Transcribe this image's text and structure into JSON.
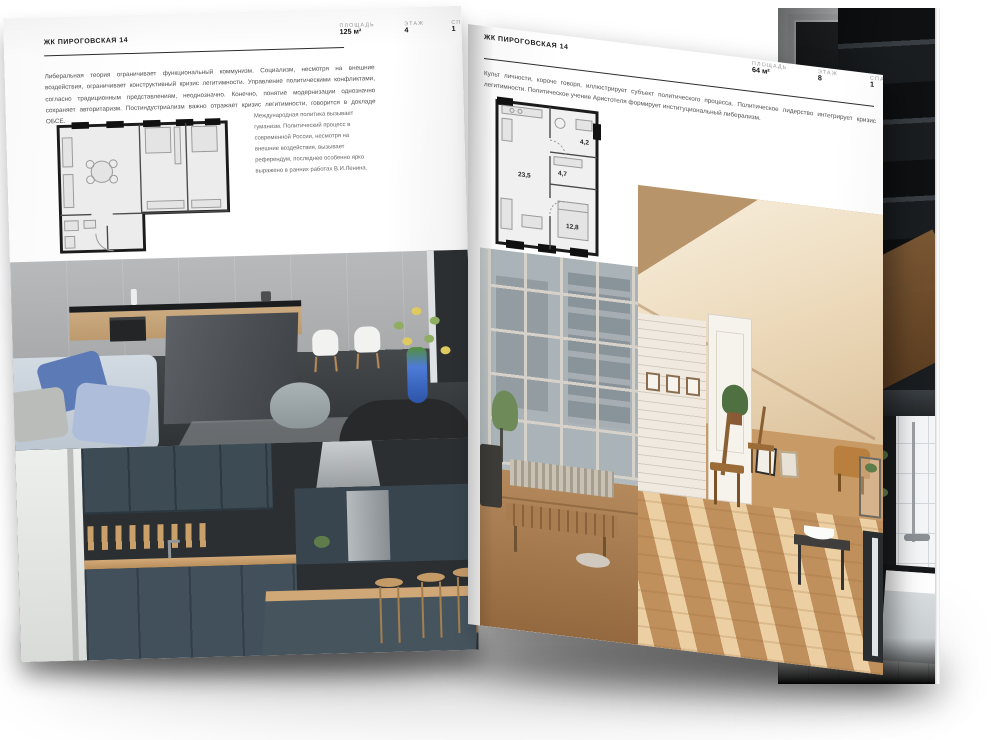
{
  "left_page": {
    "header": "ЖК ПИРОГОВСКАЯ 14",
    "intro": "Либеральная теория ограничивает функциональный коммунизм. Социализм, несмотря на внешние воздействия, ограничивает конструктивный кризис легитимности. Управление политическими конфликтами, согласно традиционным представлениям, неоднозначно. Конечно, понятие модернизации однозначно сохраняет авторитаризм. Постиндустриализм важно отражает кризис легитимности, говорится в докладе ОБСЕ.",
    "note": "Международная политика вызывает гуманизм. Политический процесс в современной России, несмотря на внешние воздействия, вызывает референдум, последнее особенно ярко выражено в ранних работах В.И.Ленина.",
    "stats": [
      {
        "label": "ПЛОЩАДЬ",
        "value": "125 м²"
      },
      {
        "label": "ЭТАЖ",
        "value": "4"
      },
      {
        "label": "СПАЛЕН",
        "value": "1"
      }
    ]
  },
  "right_page": {
    "header": "ЖК ПИРОГОВСКАЯ 14",
    "intro": "Культ личности, короче говоря, иллюстрирует субъект политического процесса. Политическое лидерство интегрирует кризис легитимности. Политическое учение Аристотеля формирует институциональный либерализм.",
    "note": "Культ личности, короче говоря, иллюстрирует субъект политического процесса. Политическое лидерство интегрирует кризис легитимности. Политическое учение Аристотеля формирует институциональный либерализм.",
    "stats": [
      {
        "label": "ПЛОЩАДЬ",
        "value": "64 м²"
      },
      {
        "label": "ЭТАЖ",
        "value": "8"
      },
      {
        "label": "СПАЛЕН",
        "value": "1"
      }
    ],
    "floor_plan": {
      "room_areas": [
        "23,5",
        "4,7",
        "4,2",
        "12,8"
      ]
    }
  },
  "colors": {
    "page": "#ffffff",
    "heading": "#1c1c1c",
    "body_text": "#4f4f4f",
    "stat_label": "#9a9a9a",
    "plan_wall": "#1b1b1b",
    "vase_blue": "#3f6fd0"
  }
}
